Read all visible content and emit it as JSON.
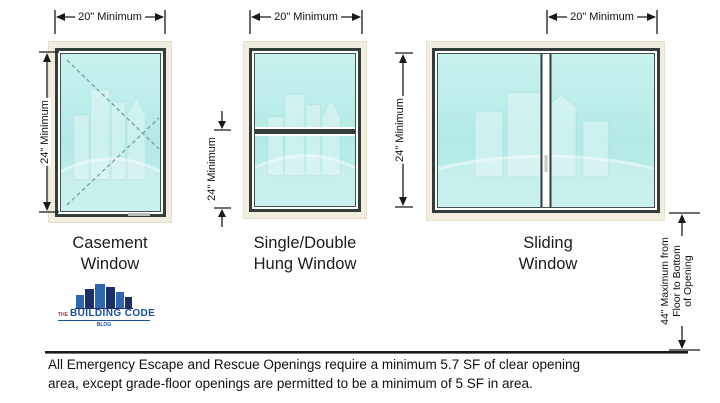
{
  "window_diagrams": [
    {
      "name": "Casement Window",
      "label_line1": "Casement",
      "label_line2": "Window",
      "width_dim": "20\" Minimum",
      "height_dim": "24\" Minimum"
    },
    {
      "name": "Single/Double Hung Window",
      "label_line1": "Single/Double",
      "label_line2": "Hung Window",
      "width_dim": "20\" Minimum",
      "height_dim": "24\" Minimum"
    },
    {
      "name": "Sliding Window",
      "label_line1": "Sliding",
      "label_line2": "Window",
      "width_dim": "20\" Minimum",
      "height_dim": "24\" Minimum"
    }
  ],
  "sill_height_dim": {
    "line1": "44\" Maximum from",
    "line2": "Floor to Bottom",
    "line3": "of Opening"
  },
  "logo": {
    "prefix": "THE",
    "title": "BUILDING CODE",
    "subtitle": "BLOG"
  },
  "note": {
    "line1": "All Emergency Escape and Rescue Openings require a minimum 5.7 SF of clear opening",
    "line2": "area, except grade-floor openings are permitted to be a minimum of 5 SF in area."
  },
  "colors": {
    "glass": "#b7ebe7",
    "frame_dark": "#323d3c",
    "frame_light": "#f1eee0",
    "dimension_line": "#1a1a1a",
    "logo_blue": "#1a4fa4",
    "logo_dark_blue": "#1c2f6b",
    "logo_red": "#a8392e"
  }
}
